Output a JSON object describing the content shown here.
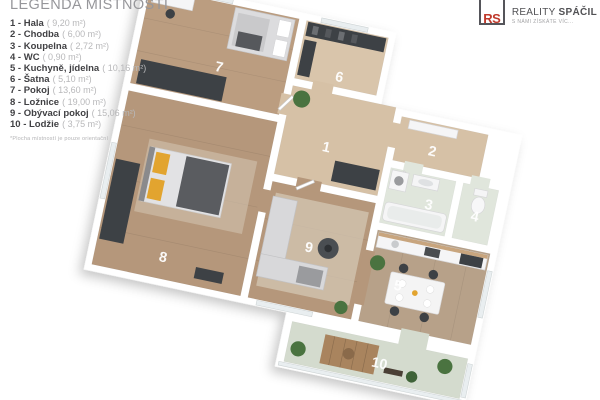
{
  "legend": {
    "title": "LEGENDA MÍSTNOSTÍ",
    "items": [
      {
        "label": "1 - Hala",
        "area": "( 9,20 m²)"
      },
      {
        "label": "2 - Chodba",
        "area": "( 6,00 m²)"
      },
      {
        "label": "3 - Koupelna",
        "area": "( 2,72 m²)"
      },
      {
        "label": "4 - WC",
        "area": "( 0,90 m²)"
      },
      {
        "label": "5 - Kuchyně, jídelna",
        "area": "( 10,16 m²)"
      },
      {
        "label": "6 - Šatna",
        "area": "( 5,10 m²)"
      },
      {
        "label": "7 - Pokoj",
        "area": "( 13,60 m²)"
      },
      {
        "label": "8 - Ložnice",
        "area": "( 19,00 m²)"
      },
      {
        "label": "9 - Obývací pokoj",
        "area": "( 15,06 m²)"
      },
      {
        "label": "10 - Lodžie",
        "area": "( 3,75 m²)"
      }
    ],
    "footnote": "*Plocha místností je pouze orientační"
  },
  "logo": {
    "monogram": "RS",
    "name_regular": "REALITY",
    "name_bold": "SPÁČIL",
    "tagline": "S NÁMI ZÍSKÁTE VÍC..."
  },
  "floorplan": {
    "room_numbers": [
      "1",
      "2",
      "3",
      "4",
      "5",
      "6",
      "7",
      "8",
      "9",
      "10"
    ]
  },
  "colors": {
    "brand_red": "#c0392b",
    "floor_beige": "#d6c1a6",
    "floor_beige_light": "#d9c5ab",
    "floor_wood": "#b5977b",
    "floor_wood_light": "#bb9d80",
    "floor_kitchen": "#b7a189",
    "floor_tile": "#e0e6dc",
    "floor_loggia": "#d4dbce",
    "furniture_dark": "#3d4145",
    "accent_yellow": "#e2a42f",
    "plant_green": "#4a7340"
  }
}
